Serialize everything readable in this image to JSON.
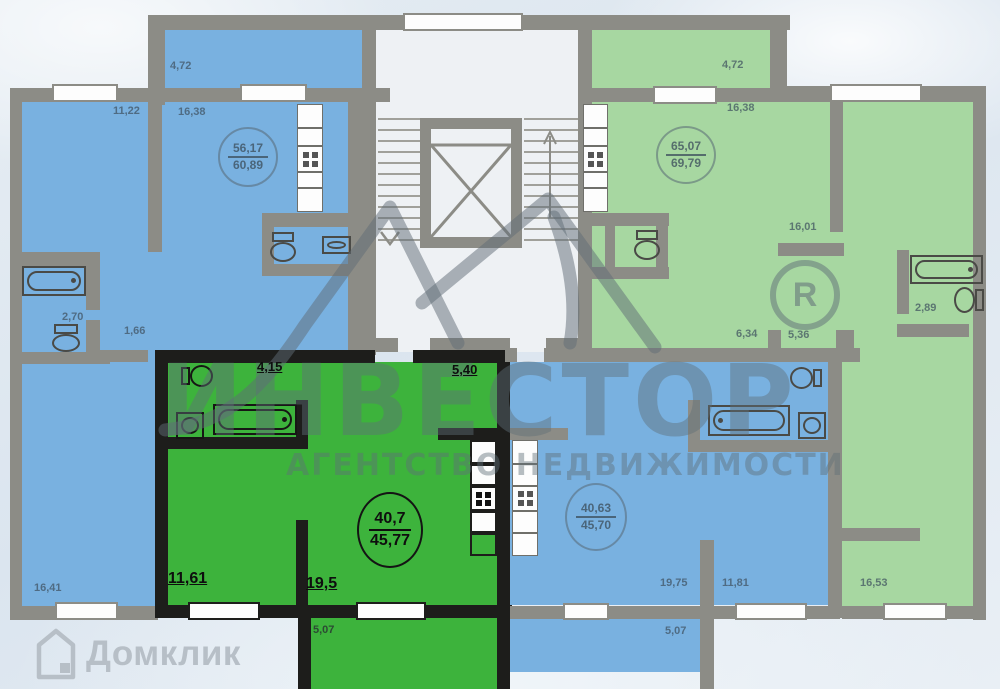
{
  "watermark": {
    "brand": "ИНВЕСТОР",
    "tagline": "АГЕНТСТВО НЕДВИЖИМОСТИ",
    "registered": "R"
  },
  "footer_logo": {
    "text": "Домклик"
  },
  "colors": {
    "selected_green": "#3db33c",
    "blue": "#79b1e0",
    "light_green": "#a7d7a1",
    "wall_gray": "#8c8c86",
    "wall_black": "#1d1d1b"
  },
  "apartments": {
    "left_blue": {
      "area_total": "56,17",
      "area_with_balcony": "60,89",
      "balcony": "4,72",
      "room1": "11,22",
      "room2": "16,38",
      "bath": "2,70",
      "wc": "1,66",
      "room3": "16,41"
    },
    "selected": {
      "area_total": "40,7",
      "area_with_balcony": "45,77",
      "bath": "4,15",
      "hall": "5,40",
      "room": "11,61",
      "living": "19,5",
      "balcony": "5,07"
    },
    "middle_blue": {
      "area_total": "40,63",
      "area_with_balcony": "45,70",
      "living": "19,75",
      "room": "11,81",
      "balcony": "5,07"
    },
    "right_green": {
      "area_total": "65,07",
      "area_with_balcony": "69,79",
      "balcony": "4,72",
      "kitchen": "16,38",
      "room1": "16,01",
      "bath": "2,89",
      "hall1": "6,34",
      "hall2": "5,36",
      "room2": "16,53"
    }
  }
}
